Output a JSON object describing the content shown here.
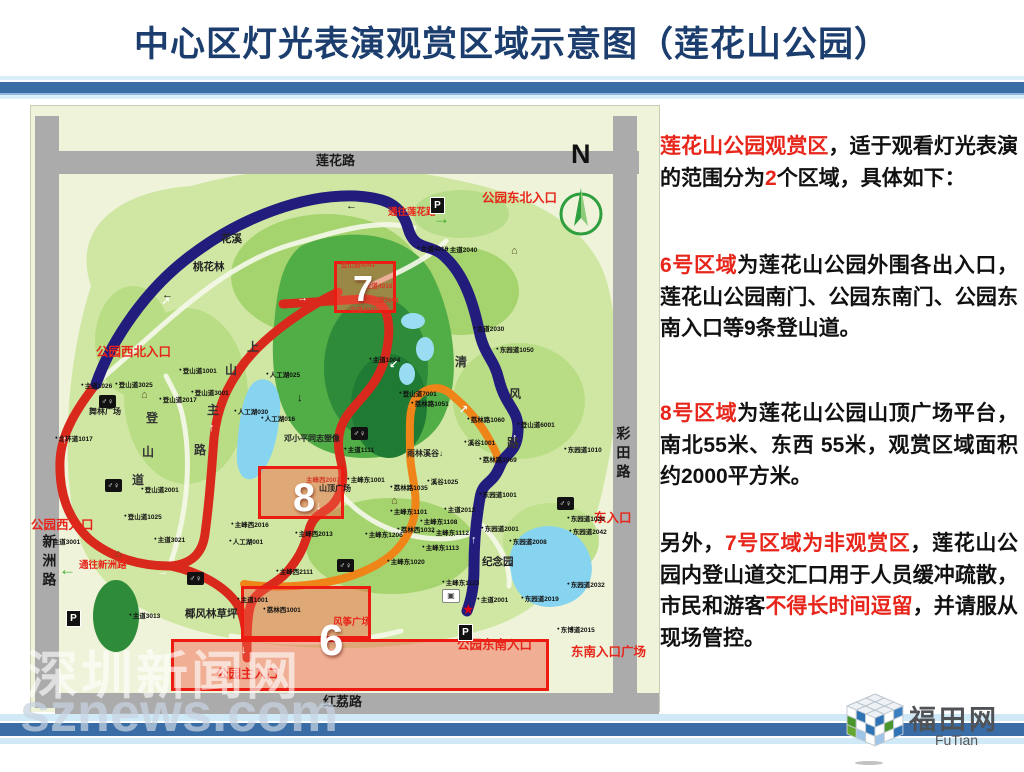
{
  "title": "中心区灯光表演观赏区域示意图（莲花山公园）",
  "colors": {
    "accent_red": "#e8251a",
    "title_blue": "#1c3e6e",
    "band_blue": "#3a6ca6",
    "path_blue": "#221c7d",
    "path_red": "#d9291c",
    "path_orange": "#ef8418",
    "zone_border": "#ec1c12",
    "road_gray": "#ababab",
    "park_green": "#cfe7a2"
  },
  "info_panel": {
    "paragraphs": [
      [
        {
          "t": "莲花山公园观赏区",
          "c": "r"
        },
        {
          "t": "，适于观看灯光表演的范围分为",
          "c": "k"
        },
        {
          "t": "2",
          "c": "r"
        },
        {
          "t": "个区域，具体如下：",
          "c": "k"
        }
      ],
      [
        {
          "t": "6号区域",
          "c": "r"
        },
        {
          "t": "为莲花山公园外围各出入口，莲花山公园南门、公园东南门、公园东南入口等9条登山道。",
          "c": "k"
        }
      ],
      [
        {
          "t": "8号区域",
          "c": "r"
        },
        {
          "t": "为莲花山公园山顶广场平台，南北55米、东西 55米，观赏区域面积约2000平方米。",
          "c": "k"
        }
      ],
      [
        {
          "t": "另外，",
          "c": "k"
        },
        {
          "t": "7号区域为非观赏区",
          "c": "r"
        },
        {
          "t": "，莲花山公园内登山道交汇口用于人员缓冲疏散，市民和游客",
          "c": "k"
        },
        {
          "t": "不得长时间逗留",
          "c": "r"
        },
        {
          "t": "，并请服从现场管控。",
          "c": "k"
        }
      ]
    ]
  },
  "map": {
    "zone6": "6",
    "zone7": "7",
    "zone8": "8",
    "labels": [
      {
        "t": "莲花路",
        "x": 285,
        "y": 48,
        "c": "roadh",
        "n": "road-label-lianhua"
      },
      {
        "t": "红荔路",
        "x": 292,
        "y": 589,
        "c": "roadh",
        "n": "road-label-hongli"
      },
      {
        "t": "新洲路",
        "x": 10,
        "y": 428,
        "c": "roadv",
        "n": "road-label-xinzhou"
      },
      {
        "t": "彩田路",
        "x": 584,
        "y": 320,
        "c": "roadv",
        "n": "road-label-caitian"
      },
      {
        "t": "N",
        "x": 540,
        "y": 34,
        "c": "north",
        "n": "north-label"
      },
      {
        "t": "公园东北入口",
        "x": 451,
        "y": 86,
        "c": "red",
        "n": "entrance-label"
      },
      {
        "t": "公园西北入口",
        "x": 65,
        "y": 240,
        "c": "red",
        "n": "entrance-label"
      },
      {
        "t": "公园西入口",
        "x": 0,
        "y": 413,
        "c": "red",
        "n": "entrance-label"
      },
      {
        "t": "东入口",
        "x": 563,
        "y": 406,
        "c": "red",
        "n": "entrance-label"
      },
      {
        "t": "东南入口广场",
        "x": 540,
        "y": 540,
        "c": "red",
        "n": "entrance-label"
      },
      {
        "t": "公园东南入口",
        "x": 426,
        "y": 533,
        "c": "red",
        "n": "entrance-label"
      },
      {
        "t": "公园主入口",
        "x": 185,
        "y": 562,
        "c": "red",
        "n": "entrance-label"
      },
      {
        "t": "通往莲花路",
        "x": 357,
        "y": 102,
        "c": "redsm",
        "n": "direction-label"
      },
      {
        "t": "通往新洲路",
        "x": 48,
        "y": 455,
        "c": "redsm",
        "n": "direction-label"
      },
      {
        "t": "风筝广场",
        "x": 302,
        "y": 512,
        "c": "redsm",
        "n": "poi-label"
      },
      {
        "t": "主峰西2007",
        "x": 275,
        "y": 371,
        "c": "redtiny"
      },
      {
        "t": "登山道4041",
        "x": 310,
        "y": 156,
        "c": "redtiny"
      },
      {
        "t": "主道4018",
        "x": 334,
        "y": 177,
        "c": "redtiny"
      },
      {
        "t": "登山道5001",
        "x": 334,
        "y": 191,
        "c": "redtiny"
      },
      {
        "t": "主道4019",
        "x": 319,
        "y": 201,
        "c": "redtiny"
      },
      {
        "t": "花溪",
        "x": 190,
        "y": 128,
        "c": "blk"
      },
      {
        "t": "桃花林",
        "x": 162,
        "y": 156,
        "c": "blk"
      },
      {
        "t": "椰风林草坪",
        "x": 154,
        "y": 503,
        "c": "blk"
      },
      {
        "t": "纪念园",
        "x": 451,
        "y": 451,
        "c": "blk"
      },
      {
        "t": "舞林广场",
        "x": 58,
        "y": 302,
        "c": "blksm"
      },
      {
        "t": "邓小平同志塑像",
        "x": 253,
        "y": 329,
        "c": "blksm"
      },
      {
        "t": "雨林溪谷↓",
        "x": 376,
        "y": 344,
        "c": "blksm"
      },
      {
        "t": "山顶广场",
        "x": 288,
        "y": 379,
        "c": "blksm"
      },
      {
        "t": "上",
        "x": 216,
        "y": 235,
        "c": "vchar"
      },
      {
        "t": "山",
        "x": 194,
        "y": 258,
        "c": "vchar"
      },
      {
        "t": "主",
        "x": 176,
        "y": 298,
        "c": "vchar"
      },
      {
        "t": "路",
        "x": 163,
        "y": 338,
        "c": "vchar"
      },
      {
        "t": "登",
        "x": 115,
        "y": 306,
        "c": "vchar"
      },
      {
        "t": "山",
        "x": 111,
        "y": 340,
        "c": "vchar"
      },
      {
        "t": "道",
        "x": 101,
        "y": 368,
        "c": "vchar"
      },
      {
        "t": "清",
        "x": 424,
        "y": 250,
        "c": "vchar"
      },
      {
        "t": "风",
        "x": 478,
        "y": 282,
        "c": "vchar"
      },
      {
        "t": "路",
        "x": 476,
        "y": 331,
        "c": "vchar"
      },
      {
        "t": "主道4016",
        "x": 386,
        "y": 140,
        "c": "tiny"
      },
      {
        "t": "主道2040",
        "x": 415,
        "y": 141,
        "c": "tiny"
      },
      {
        "t": "主道2030",
        "x": 442,
        "y": 220,
        "c": "tiny"
      },
      {
        "t": "主道1026",
        "x": 50,
        "y": 277,
        "c": "tiny"
      },
      {
        "t": "登山道3025",
        "x": 84,
        "y": 276,
        "c": "tiny"
      },
      {
        "t": "登山道1001",
        "x": 148,
        "y": 262,
        "c": "tiny"
      },
      {
        "t": "登山道3001",
        "x": 160,
        "y": 284,
        "c": "tiny"
      },
      {
        "t": "登山道2017",
        "x": 128,
        "y": 291,
        "c": "tiny"
      },
      {
        "t": "北环道1017",
        "x": 24,
        "y": 330,
        "c": "tiny"
      },
      {
        "t": "登山道2001",
        "x": 110,
        "y": 381,
        "c": "tiny"
      },
      {
        "t": "登山道1025",
        "x": 93,
        "y": 408,
        "c": "tiny"
      },
      {
        "t": "主道3001",
        "x": 18,
        "y": 433,
        "c": "tiny"
      },
      {
        "t": "主道3021",
        "x": 123,
        "y": 431,
        "c": "tiny"
      },
      {
        "t": "主道3013",
        "x": 98,
        "y": 507,
        "c": "tiny"
      },
      {
        "t": "主道1001",
        "x": 206,
        "y": 491,
        "c": "tiny"
      },
      {
        "t": "荔林西1001",
        "x": 232,
        "y": 501,
        "c": "tiny"
      },
      {
        "t": "主峰西2111",
        "x": 245,
        "y": 463,
        "c": "tiny"
      },
      {
        "t": "主峰西2016",
        "x": 200,
        "y": 416,
        "c": "tiny"
      },
      {
        "t": "主峰西2013",
        "x": 264,
        "y": 425,
        "c": "tiny"
      },
      {
        "t": "人工湖001",
        "x": 198,
        "y": 433,
        "c": "tiny"
      },
      {
        "t": "人工湖030",
        "x": 203,
        "y": 303,
        "c": "tiny"
      },
      {
        "t": "人工湖016",
        "x": 230,
        "y": 310,
        "c": "tiny"
      },
      {
        "t": "人工湖025",
        "x": 235,
        "y": 266,
        "c": "tiny"
      },
      {
        "t": "主道1004",
        "x": 338,
        "y": 251,
        "c": "tiny"
      },
      {
        "t": "主道1111",
        "x": 313,
        "y": 341,
        "c": "tiny"
      },
      {
        "t": "主峰东1001",
        "x": 316,
        "y": 371,
        "c": "tiny"
      },
      {
        "t": "登山道7001",
        "x": 368,
        "y": 285,
        "c": "tiny"
      },
      {
        "t": "荔林路1051",
        "x": 380,
        "y": 295,
        "c": "tiny"
      },
      {
        "t": "荔林路1060",
        "x": 436,
        "y": 311,
        "c": "tiny"
      },
      {
        "t": "溪谷1001",
        "x": 433,
        "y": 334,
        "c": "tiny"
      },
      {
        "t": "荔林路1069",
        "x": 448,
        "y": 351,
        "c": "tiny"
      },
      {
        "t": "登山道6001",
        "x": 486,
        "y": 316,
        "c": "tiny"
      },
      {
        "t": "东园道1050",
        "x": 465,
        "y": 241,
        "c": "tiny"
      },
      {
        "t": "溪谷1025",
        "x": 396,
        "y": 373,
        "c": "tiny"
      },
      {
        "t": "荔林路1035",
        "x": 359,
        "y": 379,
        "c": "tiny"
      },
      {
        "t": "主峰东1101",
        "x": 359,
        "y": 403,
        "c": "tiny"
      },
      {
        "t": "荔林西1032",
        "x": 366,
        "y": 421,
        "c": "tiny"
      },
      {
        "t": "主峰东1108",
        "x": 389,
        "y": 413,
        "c": "tiny"
      },
      {
        "t": "主峰东1112",
        "x": 401,
        "y": 424,
        "c": "tiny"
      },
      {
        "t": "主峰东1113",
        "x": 391,
        "y": 439,
        "c": "tiny"
      },
      {
        "t": "主峰东1206",
        "x": 334,
        "y": 426,
        "c": "tiny"
      },
      {
        "t": "主峰东1020",
        "x": 356,
        "y": 453,
        "c": "tiny"
      },
      {
        "t": "主峰东1123",
        "x": 411,
        "y": 474,
        "c": "tiny"
      },
      {
        "t": "主道2012",
        "x": 413,
        "y": 401,
        "c": "tiny"
      },
      {
        "t": "东园道1001",
        "x": 448,
        "y": 386,
        "c": "tiny"
      },
      {
        "t": "东园道2001",
        "x": 450,
        "y": 420,
        "c": "tiny"
      },
      {
        "t": "主道2001",
        "x": 446,
        "y": 491,
        "c": "tiny"
      },
      {
        "t": "东园道1010",
        "x": 533,
        "y": 341,
        "c": "tiny"
      },
      {
        "t": "东园道1020",
        "x": 536,
        "y": 410,
        "c": "tiny"
      },
      {
        "t": "东园道2042",
        "x": 538,
        "y": 423,
        "c": "tiny"
      },
      {
        "t": "东园道2008",
        "x": 478,
        "y": 433,
        "c": "tiny"
      },
      {
        "t": "东园道2032",
        "x": 536,
        "y": 476,
        "c": "tiny"
      },
      {
        "t": "东园道2019",
        "x": 490,
        "y": 490,
        "c": "tiny"
      },
      {
        "t": "东博道2015",
        "x": 526,
        "y": 521,
        "c": "tiny"
      },
      {
        "t": "P",
        "x": 400,
        "y": 92,
        "c": "pbox",
        "n": "parking-icon"
      },
      {
        "t": "P",
        "x": 36,
        "y": 505,
        "c": "pbox",
        "n": "parking-icon"
      },
      {
        "t": "P",
        "x": 428,
        "y": 519,
        "c": "pbox",
        "n": "parking-icon"
      },
      {
        "t": "♂♀",
        "x": 68,
        "y": 289,
        "c": "wc",
        "n": "toilet-icon"
      },
      {
        "t": "♂♀",
        "x": 74,
        "y": 373,
        "c": "wc",
        "n": "toilet-icon"
      },
      {
        "t": "♂♀",
        "x": 320,
        "y": 321,
        "c": "wc",
        "n": "toilet-icon"
      },
      {
        "t": "♂♀",
        "x": 526,
        "y": 391,
        "c": "wc",
        "n": "toilet-icon"
      },
      {
        "t": "♂♀",
        "x": 156,
        "y": 466,
        "c": "wc",
        "n": "toilet-icon"
      },
      {
        "t": "♂♀",
        "x": 306,
        "y": 453,
        "c": "wc",
        "n": "toilet-icon"
      },
      {
        "t": "⌂",
        "x": 480,
        "y": 139,
        "c": "pav",
        "n": "pavilion-icon"
      },
      {
        "t": "⌂",
        "x": 110,
        "y": 283,
        "c": "pav",
        "n": "pavilion-icon"
      },
      {
        "t": "⌂",
        "x": 360,
        "y": 389,
        "c": "pav",
        "n": "pavilion-icon"
      },
      {
        "t": "⌂",
        "x": 84,
        "y": 442,
        "c": "pav",
        "n": "pavilion-icon"
      },
      {
        "t": "▣",
        "x": 411,
        "y": 483,
        "c": "bus",
        "n": "bus-icon"
      },
      {
        "t": "★",
        "x": 431,
        "y": 496,
        "c": "star",
        "n": "star-icon"
      },
      {
        "t": "→",
        "x": 402,
        "y": 104,
        "c": "garr",
        "n": "green-arrow-icon"
      },
      {
        "t": "←",
        "x": 28,
        "y": 455,
        "c": "garr",
        "n": "green-arrow-icon"
      },
      {
        "t": "↑",
        "x": 31,
        "y": 328,
        "c": "warr",
        "n": "path-arrow-icon"
      },
      {
        "t": "↑",
        "x": 178,
        "y": 316,
        "c": "warr",
        "n": "path-arrow-icon"
      },
      {
        "t": "→",
        "x": 266,
        "y": 186,
        "c": "warr",
        "n": "path-arrow-icon"
      },
      {
        "t": "↓",
        "x": 285,
        "y": 394,
        "c": "warr",
        "n": "path-arrow-icon"
      },
      {
        "t": "↙",
        "x": 358,
        "y": 253,
        "c": "warr",
        "n": "path-arrow-icon"
      },
      {
        "t": "↑",
        "x": 440,
        "y": 428,
        "c": "warr",
        "n": "path-arrow-icon"
      },
      {
        "t": "↑",
        "x": 481,
        "y": 326,
        "c": "warr",
        "n": "path-arrow-icon"
      },
      {
        "t": "↗",
        "x": 428,
        "y": 298,
        "c": "warr",
        "n": "path-arrow-icon"
      },
      {
        "t": "→",
        "x": 126,
        "y": 460,
        "c": "warr",
        "n": "path-arrow-icon"
      },
      {
        "t": "↗",
        "x": 130,
        "y": 190,
        "c": "warr",
        "n": "path-arrow-icon"
      },
      {
        "t": "↓",
        "x": 210,
        "y": 538,
        "c": "warr",
        "n": "path-arrow-icon"
      },
      {
        "t": "←",
        "x": 315,
        "y": 94,
        "c": "barr",
        "n": "arrow-icon"
      },
      {
        "t": "←",
        "x": 131,
        "y": 183,
        "c": "barr",
        "n": "arrow-icon"
      },
      {
        "t": "↓",
        "x": 266,
        "y": 286,
        "c": "barr",
        "n": "arrow-icon"
      }
    ]
  },
  "watermark": {
    "line1": "深圳新闻网",
    "line2": "sznews.com"
  },
  "logo": {
    "title": "福田网",
    "subtitle": "FuTian"
  }
}
